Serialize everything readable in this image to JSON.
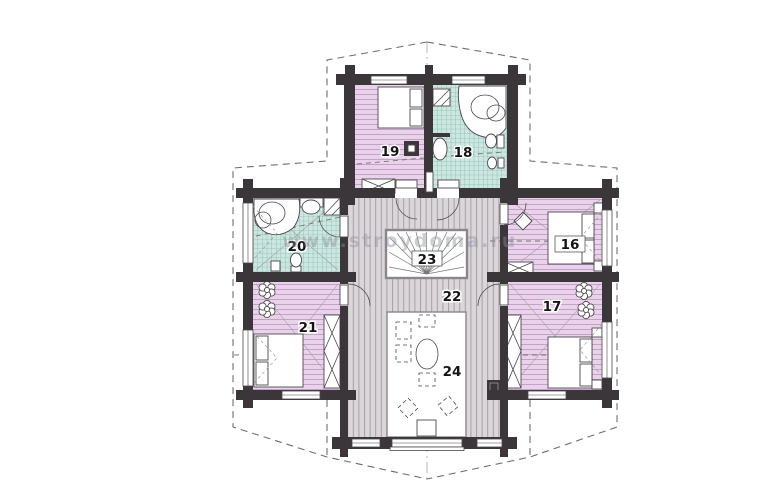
{
  "watermark": {
    "text": "www.stroydoma.ru"
  },
  "rooms": [
    {
      "number": "16"
    },
    {
      "number": "17"
    },
    {
      "number": "18"
    },
    {
      "number": "19"
    },
    {
      "number": "20"
    },
    {
      "number": "21"
    },
    {
      "number": "22"
    },
    {
      "number": "23"
    },
    {
      "number": "24"
    }
  ],
  "colors": {
    "wall": "#3a363a",
    "bedroom-floor": "#ead2ea",
    "bedroom-stripe": "#c3a2c8",
    "bath-floor": "#cce6e0",
    "bath-grid": "#6aa69c",
    "corridor-floor": "#dad6da",
    "corridor-stripe": "#a79fa7",
    "fixture-stroke": "#4c484c",
    "outline-dash": "#6e6e6e",
    "label": "#141414"
  }
}
